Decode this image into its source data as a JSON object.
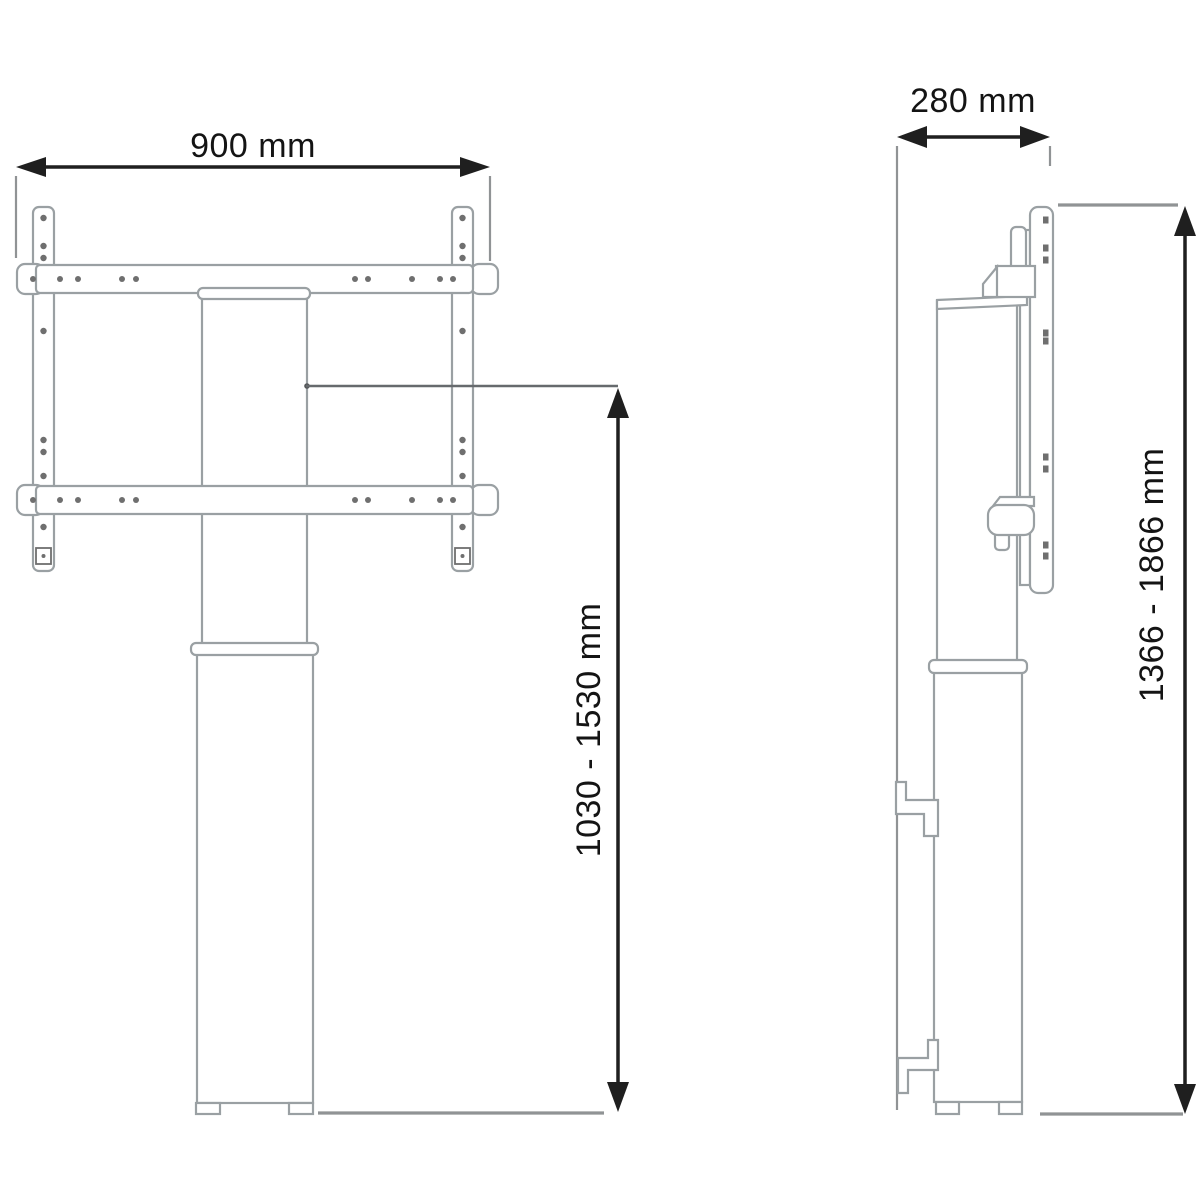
{
  "figure": {
    "kind": "technical-dimension-drawing",
    "subject": "height-adjustable display floor stand shown in front view and side view",
    "views": [
      "front-view",
      "side-view"
    ]
  },
  "dimensions": {
    "front_width": "900 mm",
    "side_depth": "280 mm",
    "front_height_range": "1030 - 1530 mm",
    "side_height_range": "1366 - 1866 mm"
  },
  "colors": {
    "background": "#ffffff",
    "object_line": "#9aa0a3",
    "hole_color": "#6f6f6f",
    "dimension_line": "#1f1f1f",
    "extension_line": "#909395",
    "text_color": "#141414"
  }
}
